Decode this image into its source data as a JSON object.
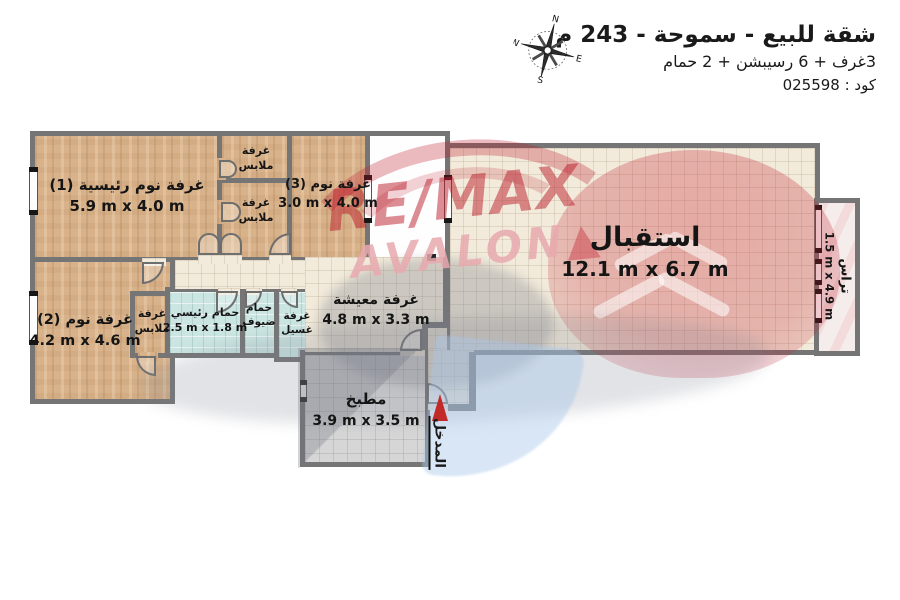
{
  "header": {
    "title": "شقة للبيع - سموحة - 243 م",
    "subtitle": "3غرف + 6 رسيبشن + 2 حمام",
    "code": "كود : 025598",
    "compass": {
      "n": "N",
      "e": "E",
      "s": "S",
      "w": "W"
    }
  },
  "watermark": {
    "brand": "RE/MAX",
    "sub": "AVALON",
    "marker": "▲"
  },
  "rooms": {
    "bed1": {
      "name": "غرفة نوم رئيسية (1)",
      "dims": "5.9 m x 4.0 m"
    },
    "closet_a": {
      "line1": "غرفة",
      "line2": "ملابس"
    },
    "closet_b": {
      "line1": "غرفة",
      "line2": "ملابس"
    },
    "bed3": {
      "name": "غرفة نوم (3)",
      "dims": "3.0 m x 4.0 m"
    },
    "reception": {
      "name": "استقبال",
      "dims": "12.1 m x 6.7 m"
    },
    "terrace": {
      "name": "تراس",
      "dims": "1.5 m x 4.9 m"
    },
    "bed2": {
      "name": "غرفة نوم (2)",
      "dims": "4.2 m x 4.6 m"
    },
    "closet_c": {
      "line1": "غرفة",
      "line2": "ملابس"
    },
    "bath_master": {
      "name": "حمام رئيسي",
      "dims": "2.5 m x 1.8 m"
    },
    "bath_guest": {
      "line1": "حمام",
      "line2": "ضيوف"
    },
    "laundry": {
      "line1": "غرفة",
      "line2": "غسيل"
    },
    "living": {
      "name": "غرفة معيشة",
      "dims": "4.8 m x 3.3 m"
    },
    "kitchen": {
      "name": "مطبخ",
      "dims": "3.9 m x 3.5 m"
    },
    "entrance": {
      "name": "المدخل"
    }
  },
  "colors": {
    "wall": "#757575",
    "wood": "#d8b28a",
    "tile_cream": "#f2ebdb",
    "bath_blue": "#cbe5e2",
    "kitchen_gray": "#d6d6d6",
    "terrace_pink": "#f5edeb",
    "entrance_red": "#c22a2a",
    "brand_red": "#c01f2f",
    "brand_pink": "#e8a9ae"
  }
}
